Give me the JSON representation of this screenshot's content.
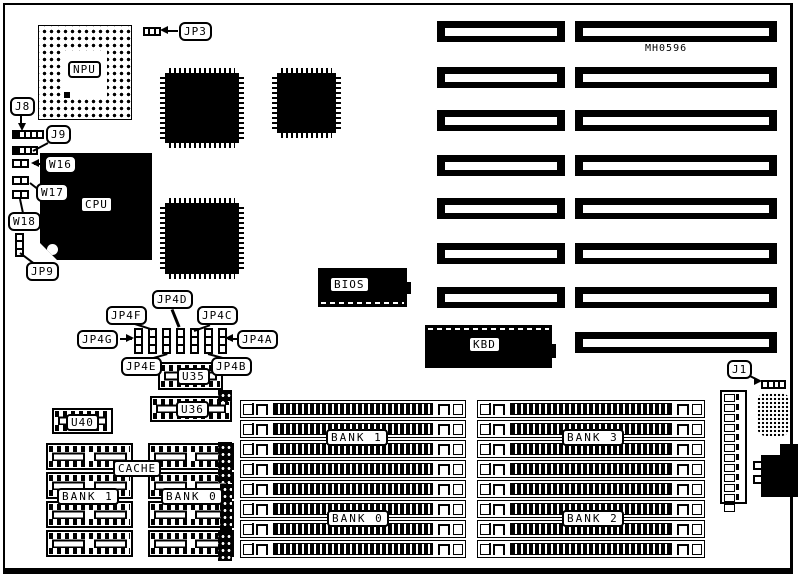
{
  "board": {
    "part_number": "MH0596"
  },
  "chips": {
    "npu": "NPU",
    "cpu": "CPU",
    "bios": "BIOS",
    "kbd": "KBD"
  },
  "jumpers": {
    "jp3": "JP3",
    "j8": "J8",
    "j9": "J9",
    "w16": "W16",
    "w17": "W17",
    "w18": "W18",
    "jp9": "JP9",
    "jp4a": "JP4A",
    "jp4b": "JP4B",
    "jp4c": "JP4C",
    "jp4d": "JP4D",
    "jp4e": "JP4E",
    "jp4f": "JP4F",
    "jp4g": "JP4G",
    "j1": "J1"
  },
  "sockets": {
    "u35": "U35",
    "u36": "U36",
    "u40": "U40"
  },
  "cache": {
    "label": "CACHE",
    "bank1": "BANK 1",
    "bank0": "BANK 0"
  },
  "memory": {
    "bank1": "BANK 1",
    "bank0": "BANK 0",
    "bank3": "BANK 3",
    "bank2": "BANK 2"
  }
}
